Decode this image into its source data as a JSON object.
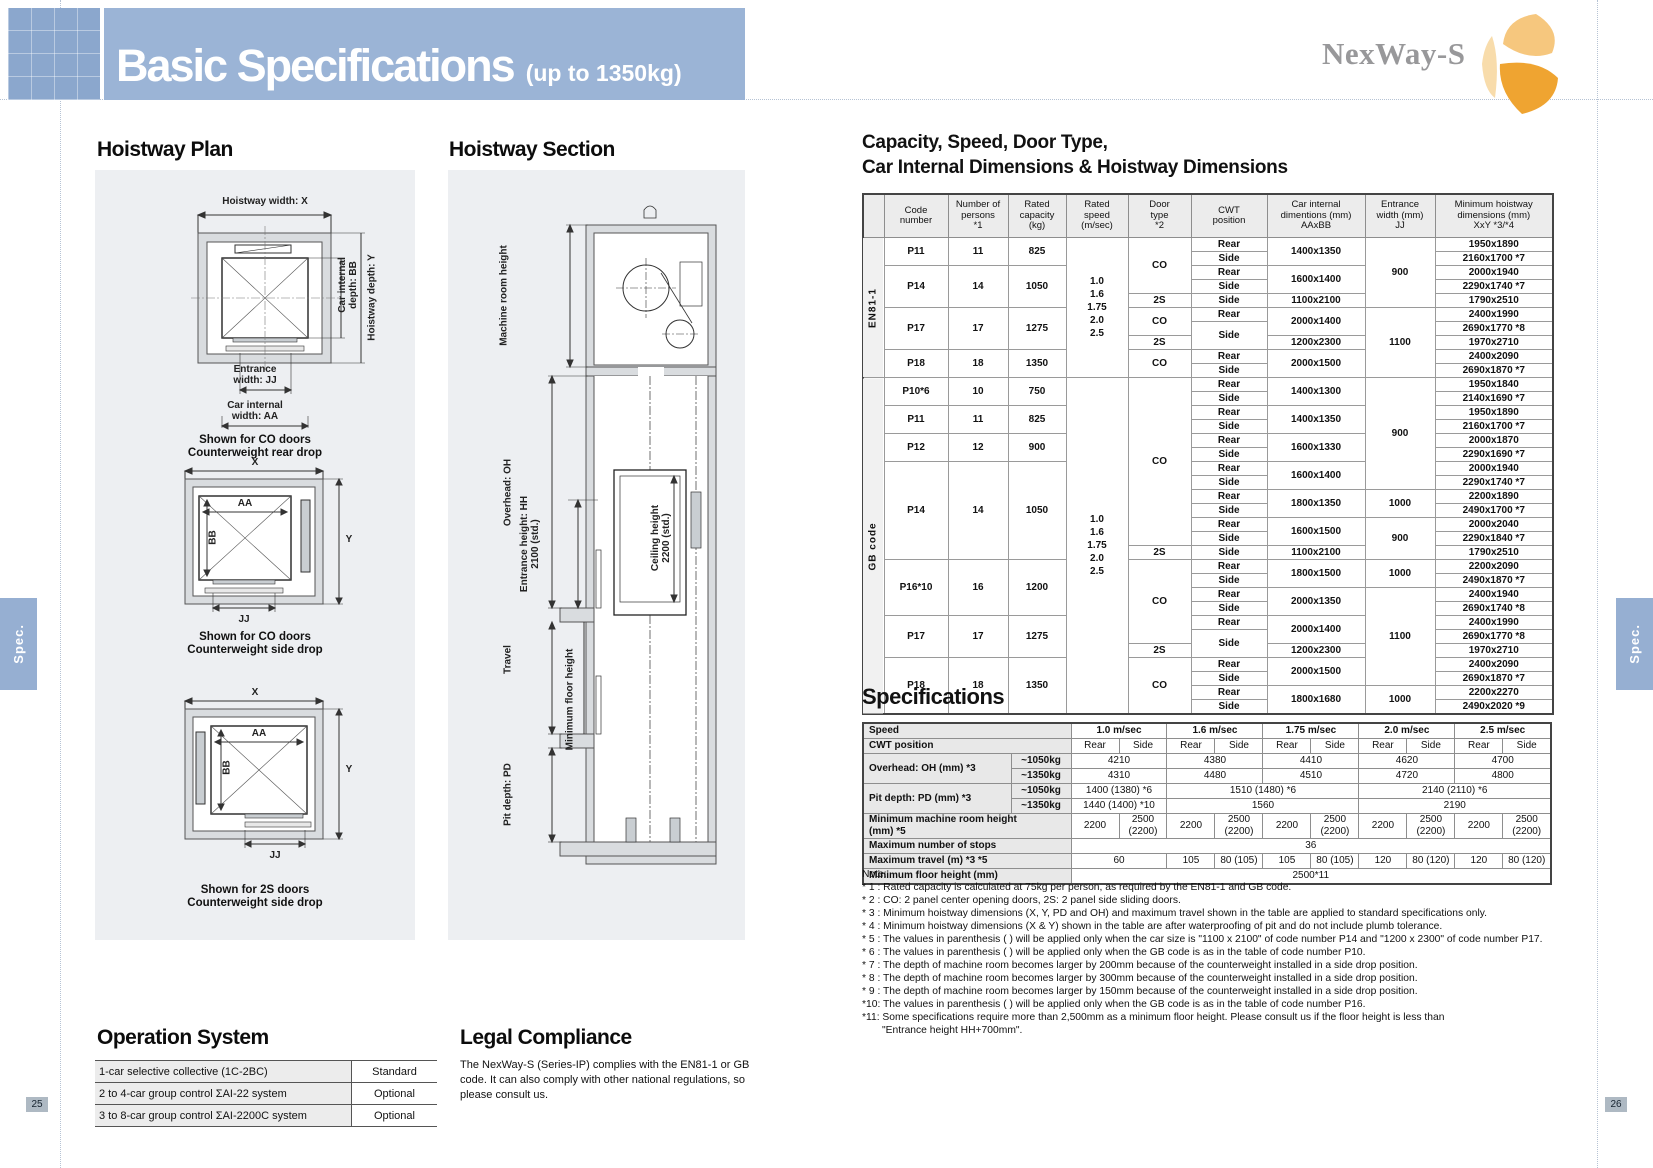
{
  "header": {
    "title": "Basic Specifications",
    "subtitle": "(up to 1350kg)",
    "logo": "NexWay-S"
  },
  "side_tabs": {
    "left": "Spec.",
    "right": "Spec."
  },
  "page_numbers": {
    "left": "25",
    "right": "26"
  },
  "hoistway_plan": {
    "heading": "Hoistway Plan",
    "plans": [
      {
        "top": "Hoistway width: X",
        "right_inner": "Car internal\ndepth: BB",
        "right_outer": "Hoistway depth: Y",
        "bottom_inner": "Entrance\nwidth: JJ",
        "bottom_outer": "Car internal\nwidth: AA",
        "caption": "Shown for CO doors\nCounterweight rear drop"
      },
      {
        "top": "X",
        "aa": "AA",
        "bb": "BB",
        "y": "Y",
        "jj": "JJ",
        "caption": "Shown for CO doors\nCounterweight side drop"
      },
      {
        "top": "X",
        "aa": "AA",
        "bb": "BB",
        "y": "Y",
        "jj": "JJ",
        "caption": "Shown for 2S doors\nCounterweight side drop"
      }
    ]
  },
  "hoistway_section": {
    "heading": "Hoistway Section",
    "labels": {
      "machine_room": "Machine room height",
      "overhead": "Overhead: OH",
      "entrance": "Entrance height: HH\n2100 (std.)",
      "ceiling": "Ceiling height\n2200 (std.)",
      "travel": "Travel",
      "min_floor": "Minimum floor height",
      "pit": "Pit depth: PD"
    }
  },
  "capacity_table": {
    "heading_line1": "Capacity, Speed, Door Type,",
    "heading_line2": "Car Internal Dimensions & Hoistway Dimensions",
    "rows": [
      [
        {
          "t": "",
          "h": 1
        },
        {
          "t": "Code\nnumber",
          "h": 1
        },
        {
          "t": "Number of\npersons\n*1",
          "h": 1
        },
        {
          "t": "Rated\ncapacity\n(kg)",
          "h": 1
        },
        {
          "t": "Rated\nspeed\n(m/sec)",
          "h": 1
        },
        {
          "t": "Door\ntype\n*2",
          "h": 1
        },
        {
          "t": "CWT\nposition",
          "h": 1
        },
        {
          "t": "Car internal\ndimentions (mm)\nAAxBB",
          "h": 1
        },
        {
          "t": "Entrance\nwidth (mm)\nJJ",
          "h": 1
        },
        {
          "t": "Minimum hoistway\ndimensions (mm)\nXxY *3/*4",
          "h": 1
        }
      ],
      [
        {
          "t": "EN81-1",
          "rs": 10,
          "c": "grp"
        },
        {
          "t": "P11",
          "rs": 2
        },
        {
          "t": "11",
          "rs": 2
        },
        {
          "t": "825",
          "rs": 2
        },
        {
          "t": "1.0\n1.6\n1.75\n2.0\n2.5",
          "rs": 10,
          "c": "speed"
        },
        {
          "t": "CO",
          "rs": 4
        },
        {
          "t": "Rear"
        },
        {
          "t": "1400x1350",
          "rs": 2
        },
        {
          "t": "900",
          "rs": 5
        },
        {
          "t": "1950x1890"
        }
      ],
      [
        {
          "t": "Side"
        },
        {
          "t": "2160x1700 *7"
        }
      ],
      [
        {
          "t": "P14",
          "rs": 3
        },
        {
          "t": "14",
          "rs": 3
        },
        {
          "t": "1050",
          "rs": 3
        },
        {
          "t": "Rear"
        },
        {
          "t": "1600x1400",
          "rs": 2
        },
        {
          "t": "2000x1940"
        }
      ],
      [
        {
          "t": "Side"
        },
        {
          "t": "2290x1740 *7"
        }
      ],
      [
        {
          "t": "2S"
        },
        {
          "t": "Side"
        },
        {
          "t": "1100x2100"
        },
        {
          "t": "1790x2510"
        }
      ],
      [
        {
          "t": "P17",
          "rs": 3
        },
        {
          "t": "17",
          "rs": 3
        },
        {
          "t": "1275",
          "rs": 3
        },
        {
          "t": "CO",
          "rs": 2
        },
        {
          "t": "Rear"
        },
        {
          "t": "2000x1400",
          "rs": 2
        },
        {
          "t": "1100",
          "rs": 5
        },
        {
          "t": "2400x1990"
        }
      ],
      [
        {
          "t": "Side",
          "rs": 2
        },
        {
          "t": "2690x1770 *8"
        }
      ],
      [
        {
          "t": "2S"
        },
        {
          "t": "1200x2300"
        },
        {
          "t": "1970x2710"
        }
      ],
      [
        {
          "t": "P18",
          "rs": 2
        },
        {
          "t": "18",
          "rs": 2
        },
        {
          "t": "1350",
          "rs": 2
        },
        {
          "t": "CO",
          "rs": 2
        },
        {
          "t": "Rear"
        },
        {
          "t": "2000x1500",
          "rs": 2
        },
        {
          "t": "2400x2090"
        }
      ],
      [
        {
          "t": "Side"
        },
        {
          "t": "2690x1870 *7"
        }
      ],
      [
        {
          "t": "GB code",
          "rs": 24,
          "c": "grp"
        },
        {
          "t": "P10*6",
          "rs": 2
        },
        {
          "t": "10",
          "rs": 2
        },
        {
          "t": "750",
          "rs": 2
        },
        {
          "t": "1.0\n1.6\n1.75\n2.0\n2.5",
          "rs": 24,
          "c": "speed"
        },
        {
          "t": "CO",
          "rs": 12
        },
        {
          "t": "Rear"
        },
        {
          "t": "1400x1300",
          "rs": 2
        },
        {
          "t": "900",
          "rs": 8
        },
        {
          "t": "1950x1840"
        }
      ],
      [
        {
          "t": "Side"
        },
        {
          "t": "2140x1690 *7"
        }
      ],
      [
        {
          "t": "P11",
          "rs": 2
        },
        {
          "t": "11",
          "rs": 2
        },
        {
          "t": "825",
          "rs": 2
        },
        {
          "t": "Rear"
        },
        {
          "t": "1400x1350",
          "rs": 2
        },
        {
          "t": "1950x1890"
        }
      ],
      [
        {
          "t": "Side"
        },
        {
          "t": "2160x1700 *7"
        }
      ],
      [
        {
          "t": "P12",
          "rs": 2
        },
        {
          "t": "12",
          "rs": 2
        },
        {
          "t": "900",
          "rs": 2
        },
        {
          "t": "Rear"
        },
        {
          "t": "1600x1330",
          "rs": 2
        },
        {
          "t": "2000x1870"
        }
      ],
      [
        {
          "t": "Side"
        },
        {
          "t": "2290x1690 *7"
        }
      ],
      [
        {
          "t": "P14",
          "rs": 7
        },
        {
          "t": "14",
          "rs": 7
        },
        {
          "t": "1050",
          "rs": 7
        },
        {
          "t": "Rear"
        },
        {
          "t": "1600x1400",
          "rs": 2
        },
        {
          "t": "2000x1940"
        }
      ],
      [
        {
          "t": "Side"
        },
        {
          "t": "2290x1740 *7"
        }
      ],
      [
        {
          "t": "Rear"
        },
        {
          "t": "1800x1350",
          "rs": 2
        },
        {
          "t": "1000",
          "rs": 2
        },
        {
          "t": "2200x1890"
        }
      ],
      [
        {
          "t": "Side"
        },
        {
          "t": "2490x1700 *7"
        }
      ],
      [
        {
          "t": "Rear"
        },
        {
          "t": "1600x1500",
          "rs": 2
        },
        {
          "t": "900",
          "rs": 3
        },
        {
          "t": "2000x2040"
        }
      ],
      [
        {
          "t": "Side"
        },
        {
          "t": "2290x1840 *7"
        }
      ],
      [
        {
          "t": "2S"
        },
        {
          "t": "Side"
        },
        {
          "t": "1100x2100"
        },
        {
          "t": "1790x2510"
        }
      ],
      [
        {
          "t": "P16*10",
          "rs": 4
        },
        {
          "t": "16",
          "rs": 4
        },
        {
          "t": "1200",
          "rs": 4
        },
        {
          "t": "CO",
          "rs": 6
        },
        {
          "t": "Rear"
        },
        {
          "t": "1800x1500",
          "rs": 2
        },
        {
          "t": "1000",
          "rs": 2
        },
        {
          "t": "2200x2090"
        }
      ],
      [
        {
          "t": "Side"
        },
        {
          "t": "2490x1870 *7"
        }
      ],
      [
        {
          "t": "Rear"
        },
        {
          "t": "2000x1350",
          "rs": 2
        },
        {
          "t": "1100",
          "rs": 7
        },
        {
          "t": "2400x1940"
        }
      ],
      [
        {
          "t": "Side"
        },
        {
          "t": "2690x1740 *8"
        }
      ],
      [
        {
          "t": "P17",
          "rs": 3
        },
        {
          "t": "17",
          "rs": 3
        },
        {
          "t": "1275",
          "rs": 3
        },
        {
          "t": "Rear"
        },
        {
          "t": "2000x1400",
          "rs": 2
        },
        {
          "t": "2400x1990"
        }
      ],
      [
        {
          "t": "Side",
          "rs": 2
        },
        {
          "t": "2690x1770 *8"
        }
      ],
      [
        {
          "t": "2S"
        },
        {
          "t": "1200x2300"
        },
        {
          "t": "1970x2710"
        }
      ],
      [
        {
          "t": "P18",
          "rs": 4
        },
        {
          "t": "18",
          "rs": 4
        },
        {
          "t": "1350",
          "rs": 4
        },
        {
          "t": "CO",
          "rs": 4
        },
        {
          "t": "Rear"
        },
        {
          "t": "2000x1500",
          "rs": 2
        },
        {
          "t": "2400x2090"
        }
      ],
      [
        {
          "t": "Side"
        },
        {
          "t": "2690x1870 *7"
        }
      ],
      [
        {
          "t": "Rear"
        },
        {
          "t": "1800x1680",
          "rs": 2
        },
        {
          "t": "1000",
          "rs": 2
        },
        {
          "t": "2200x2270"
        }
      ],
      [
        {
          "t": "Side"
        },
        {
          "t": "2490x2020 *9"
        }
      ]
    ]
  },
  "spec_table": {
    "heading": "Specifications",
    "rows": [
      [
        {
          "t": "Speed",
          "cs": 2,
          "c": "lbl",
          "h": 1
        },
        {
          "t": "1.0 m/sec",
          "cs": 2,
          "h": 1
        },
        {
          "t": "1.6 m/sec",
          "cs": 2,
          "h": 1
        },
        {
          "t": "1.75 m/sec",
          "cs": 2,
          "h": 1
        },
        {
          "t": "2.0 m/sec",
          "cs": 2,
          "h": 1
        },
        {
          "t": "2.5 m/sec",
          "cs": 2,
          "h": 1
        }
      ],
      [
        {
          "t": "CWT position",
          "cs": 2,
          "c": "lbl"
        },
        {
          "t": "Rear"
        },
        {
          "t": "Side"
        },
        {
          "t": "Rear"
        },
        {
          "t": "Side"
        },
        {
          "t": "Rear"
        },
        {
          "t": "Side"
        },
        {
          "t": "Rear"
        },
        {
          "t": "Side"
        },
        {
          "t": "Rear"
        },
        {
          "t": "Side"
        }
      ],
      [
        {
          "t": "Overhead: OH (mm) *3",
          "rs": 2,
          "c": "lbl"
        },
        {
          "t": "~1050kg",
          "c": "sub"
        },
        {
          "t": "4210",
          "cs": 2
        },
        {
          "t": "4380",
          "cs": 2
        },
        {
          "t": "4410",
          "cs": 2
        },
        {
          "t": "4620",
          "cs": 2
        },
        {
          "t": "4700",
          "cs": 2
        }
      ],
      [
        {
          "t": "~1350kg",
          "c": "sub"
        },
        {
          "t": "4310",
          "cs": 2
        },
        {
          "t": "4480",
          "cs": 2
        },
        {
          "t": "4510",
          "cs": 2
        },
        {
          "t": "4720",
          "cs": 2
        },
        {
          "t": "4800",
          "cs": 2
        }
      ],
      [
        {
          "t": "Pit depth: PD (mm) *3",
          "rs": 2,
          "c": "lbl"
        },
        {
          "t": "~1050kg",
          "c": "sub"
        },
        {
          "t": "1400 (1380) *6",
          "cs": 2
        },
        {
          "t": "1510 (1480) *6",
          "cs": 4
        },
        {
          "t": "2140 (2110) *6",
          "cs": 4
        }
      ],
      [
        {
          "t": "~1350kg",
          "c": "sub"
        },
        {
          "t": "1440 (1400) *10",
          "cs": 2
        },
        {
          "t": "1560",
          "cs": 4
        },
        {
          "t": "2190",
          "cs": 4
        }
      ],
      [
        {
          "t": "Minimum machine room height\n(mm) *5",
          "cs": 2,
          "c": "lbl"
        },
        {
          "t": "2200"
        },
        {
          "t": "2500\n(2200)"
        },
        {
          "t": "2200"
        },
        {
          "t": "2500\n(2200)"
        },
        {
          "t": "2200"
        },
        {
          "t": "2500\n(2200)"
        },
        {
          "t": "2200"
        },
        {
          "t": "2500\n(2200)"
        },
        {
          "t": "2200"
        },
        {
          "t": "2500\n(2200)"
        }
      ],
      [
        {
          "t": "Maximum number of stops",
          "cs": 2,
          "c": "lbl"
        },
        {
          "t": "36",
          "cs": 10
        }
      ],
      [
        {
          "t": "Maximum travel (m) *3 *5",
          "cs": 2,
          "c": "lbl"
        },
        {
          "t": "60",
          "cs": 2
        },
        {
          "t": "105"
        },
        {
          "t": "80 (105)"
        },
        {
          "t": "105"
        },
        {
          "t": "80 (105)"
        },
        {
          "t": "120"
        },
        {
          "t": "80 (120)"
        },
        {
          "t": "120"
        },
        {
          "t": "80 (120)"
        }
      ],
      [
        {
          "t": "Minimum floor height (mm)",
          "cs": 2,
          "c": "lbl"
        },
        {
          "t": "2500*11",
          "cs": 10
        }
      ]
    ]
  },
  "notes": {
    "label": "Note:",
    "items": [
      "* 1 : Rated capacity is calculated at 75kg per person, as required by the EN81-1 and GB code.",
      "* 2 : CO: 2 panel center opening doors, 2S: 2 panel side sliding doors.",
      "* 3 : Minimum hoistway dimensions (X, Y, PD and OH) and maximum travel shown in the table are applied to standard specifications only.",
      "* 4 : Minimum hoistway dimensions (X & Y) shown in the table are after waterproofing of pit and do not include plumb tolerance.",
      "* 5 : The values in parenthesis ( ) will be applied only when the car size is \"1100 x 2100\" of code number P14 and \"1200 x 2300\" of code number P17.",
      "* 6 : The values in parenthesis ( ) will be applied only when the GB code is as in the table of code number P10.",
      "* 7 : The depth of machine room becomes larger by 200mm because of the counterweight installed in a side drop position.",
      "* 8 : The depth of machine room becomes larger by 300mm because of the counterweight installed in a side drop position.",
      "* 9 : The depth of machine room becomes larger by 150mm because of the counterweight installed in a side drop position.",
      "*10: The values in parenthesis ( ) will be applied only when the GB code is as in the table of code number P16.",
      "*11: Some specifications require more than 2,500mm as a minimum floor height. Please consult us if the floor height is less than\n       \"Entrance height HH+700mm\"."
    ]
  },
  "operation_system": {
    "heading": "Operation System",
    "rows": [
      [
        {
          "t": "1-car selective collective (1C-2BC)",
          "c": "lbl"
        },
        {
          "t": "Standard"
        }
      ],
      [
        {
          "t": "2 to 4-car group control ΣAI-22 system",
          "c": "lbl"
        },
        {
          "t": "Optional"
        }
      ],
      [
        {
          "t": "3 to 8-car group control ΣAI-2200C system",
          "c": "lbl"
        },
        {
          "t": "Optional"
        }
      ]
    ]
  },
  "legal": {
    "heading": "Legal Compliance",
    "body": "The NexWay-S (Series-IP) complies with the EN81-1 or GB code. It can also comply with other national regulations, so please consult us."
  }
}
